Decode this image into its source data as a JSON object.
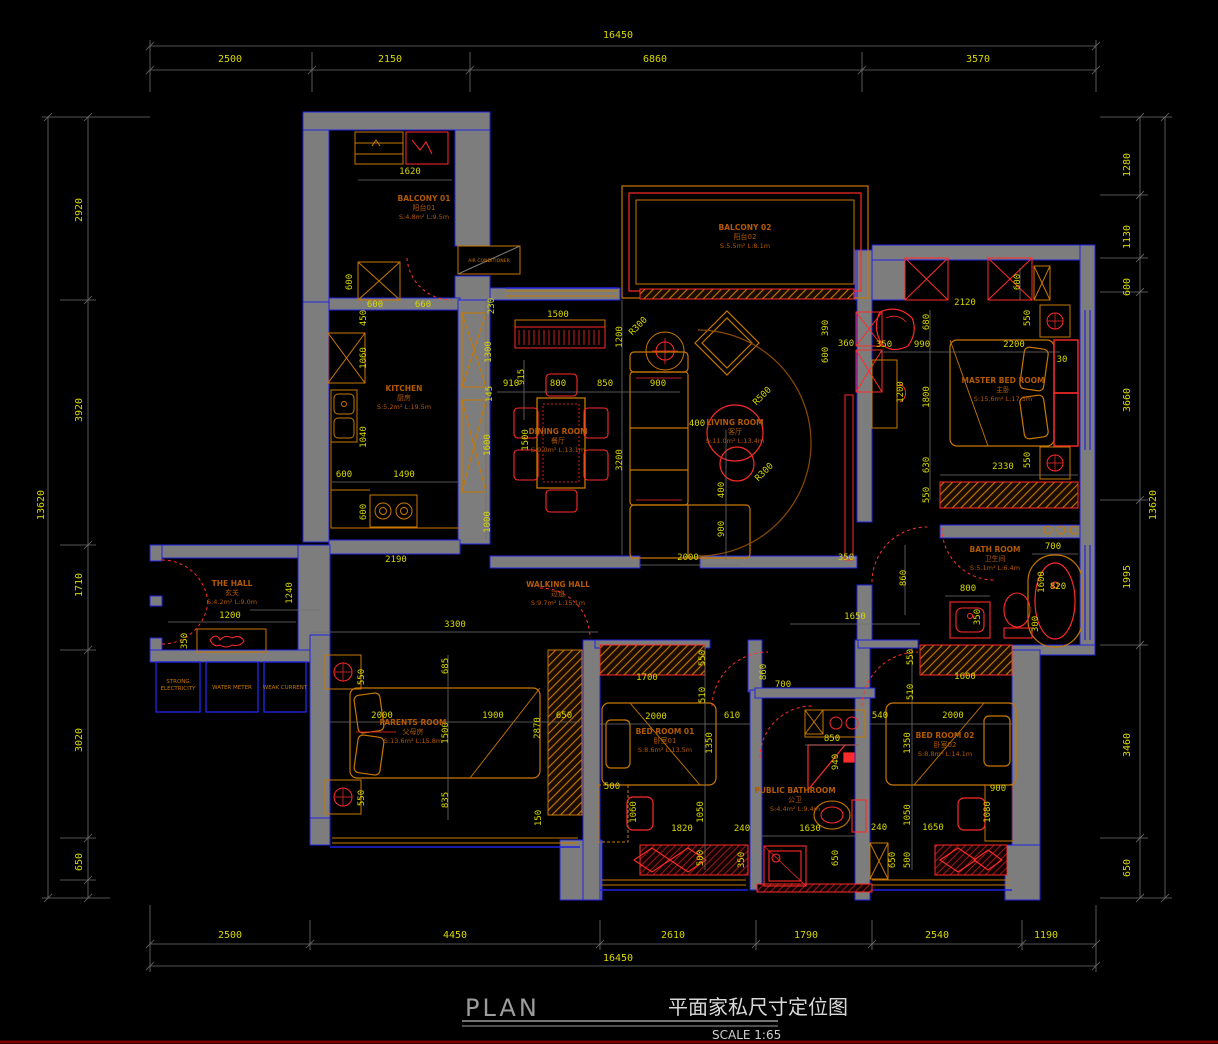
{
  "title_block": {
    "plan": "PLAN",
    "cn_title": "平面家私尺寸定位图",
    "scale": "SCALE 1:65"
  },
  "colors": {
    "background": "#000000",
    "wall_fill": "#7d7d7d",
    "outline_blue": "#2222e0",
    "dimension_text": "#d8d800",
    "dimension_line": "#6f6f6f",
    "furniture_orange": "#c87800",
    "furniture_red": "#ff2a2a",
    "room_label": "#b35900",
    "title_gray": "#9c9c9c",
    "bottom_rule_dark_red": "#7a0000"
  },
  "outer_dimensions": {
    "top": {
      "total": "16450",
      "segments": [
        "2500",
        "2150",
        "6860",
        "3570"
      ]
    },
    "bottom": {
      "total": "16450",
      "segments": [
        "2500",
        "4450",
        "2610",
        "1790",
        "2540",
        "1190"
      ]
    },
    "left": {
      "total": "13620",
      "segments": [
        "2920",
        "3920",
        "1710",
        "3020",
        "650"
      ]
    },
    "right": {
      "total": "13620",
      "segments": [
        "1280",
        "1130",
        "600",
        "3660",
        "1995",
        "3460",
        "650"
      ]
    }
  },
  "rooms": [
    {
      "id": "balcony-01",
      "name": "BALCONY 01",
      "cn": "阳台01",
      "info": "S:4.8m²  L:9.5m",
      "x": 424,
      "y": 201
    },
    {
      "id": "balcony-02",
      "name": "BALCONY 02",
      "cn": "阳台02",
      "info": "S:5.5m²  L:8.1m",
      "x": 745,
      "y": 230
    },
    {
      "id": "kitchen",
      "name": "KITCHEN",
      "cn": "厨房",
      "info": "S:5.2m²  L:19.5m",
      "x": 404,
      "y": 391
    },
    {
      "id": "dining-room",
      "name": "DINING ROOM",
      "cn": "餐厅",
      "info": "S:9.0m²  L:13.1m",
      "x": 558,
      "y": 434
    },
    {
      "id": "living-room",
      "name": "LIVING ROOM",
      "cn": "客厅",
      "info": "S:11.0m²  L:13.4m",
      "x": 735,
      "y": 425
    },
    {
      "id": "master-bed-room",
      "name": "MASTER BED ROOM",
      "cn": "主卧",
      "info": "S:15.6m²  L:17.3m",
      "x": 1003,
      "y": 383
    },
    {
      "id": "bath-room",
      "name": "BATH ROOM",
      "cn": "卫生间",
      "info": "S:5.1m²  L:6.4m",
      "x": 995,
      "y": 552
    },
    {
      "id": "the-hall",
      "name": "THE HALL",
      "cn": "玄关",
      "info": "S:4.2m²  L:9.0m",
      "x": 232,
      "y": 586
    },
    {
      "id": "walking-hall",
      "name": "WALKING HALL",
      "cn": "过道",
      "info": "S:9.7m²  L:15.1m",
      "x": 558,
      "y": 587
    },
    {
      "id": "parents-room",
      "name": "PARENTS ROOM",
      "cn": "父母房",
      "info": "S:13.6m²  L:15.8m",
      "x": 413,
      "y": 725
    },
    {
      "id": "bed-room-01",
      "name": "BED ROOM 01",
      "cn": "卧室01",
      "info": "S:8.6m²  L:13.5m",
      "x": 665,
      "y": 734
    },
    {
      "id": "public-bathroom",
      "name": "PUBLIC BATHROOM",
      "cn": "公卫",
      "info": "S:4.4m²  L:9.4m",
      "x": 795,
      "y": 793
    },
    {
      "id": "bed-room-02",
      "name": "BED ROOM 02",
      "cn": "卧室02",
      "info": "S:8.8m²  L:14.1m",
      "x": 945,
      "y": 738
    }
  ],
  "utilities": [
    {
      "lines": [
        "STRONG",
        "ELECTRICITY"
      ],
      "x": 178,
      "y": 683
    },
    {
      "lines": [
        "WATER METER"
      ],
      "x": 232,
      "y": 689
    },
    {
      "lines": [
        "WEAK CURRENT"
      ],
      "x": 285,
      "y": 689
    }
  ],
  "equipment": {
    "air_conditioner": "AIR CONDITIONER",
    "x": 489,
    "y": 262
  },
  "dim_labels": [
    {
      "g": "top",
      "t": "16450",
      "x": 618,
      "y": 38,
      "r": 0,
      "big": true
    },
    {
      "g": "top",
      "t": "2500",
      "x": 230,
      "y": 62,
      "r": 0,
      "big": true
    },
    {
      "g": "top",
      "t": "2150",
      "x": 390,
      "y": 62,
      "r": 0,
      "big": true
    },
    {
      "g": "top",
      "t": "6860",
      "x": 655,
      "y": 62,
      "r": 0,
      "big": true
    },
    {
      "g": "top",
      "t": "3570",
      "x": 978,
      "y": 62,
      "r": 0,
      "big": true
    },
    {
      "g": "bottom",
      "t": "2500",
      "x": 230,
      "y": 938,
      "r": 0,
      "big": true
    },
    {
      "g": "bottom",
      "t": "4450",
      "x": 455,
      "y": 938,
      "r": 0,
      "big": true
    },
    {
      "g": "bottom",
      "t": "2610",
      "x": 673,
      "y": 938,
      "r": 0,
      "big": true
    },
    {
      "g": "bottom",
      "t": "1790",
      "x": 806,
      "y": 938,
      "r": 0,
      "big": true
    },
    {
      "g": "bottom",
      "t": "2540",
      "x": 937,
      "y": 938,
      "r": 0,
      "big": true
    },
    {
      "g": "bottom",
      "t": "1190",
      "x": 1046,
      "y": 938,
      "r": 0,
      "big": true
    },
    {
      "g": "bottom",
      "t": "16450",
      "x": 618,
      "y": 961,
      "r": 0,
      "big": true
    },
    {
      "g": "left",
      "t": "13620",
      "x": 44,
      "y": 505,
      "r": -90,
      "big": true
    },
    {
      "g": "left",
      "t": "2920",
      "x": 82,
      "y": 210,
      "r": -90,
      "big": true
    },
    {
      "g": "left",
      "t": "3920",
      "x": 82,
      "y": 410,
      "r": -90,
      "big": true
    },
    {
      "g": "left",
      "t": "1710",
      "x": 82,
      "y": 585,
      "r": -90,
      "big": true
    },
    {
      "g": "left",
      "t": "3020",
      "x": 82,
      "y": 740,
      "r": -90,
      "big": true
    },
    {
      "g": "left",
      "t": "650",
      "x": 82,
      "y": 862,
      "r": -90,
      "big": true
    },
    {
      "g": "right",
      "t": "13620",
      "x": 1156,
      "y": 505,
      "r": -90,
      "big": true
    },
    {
      "g": "right",
      "t": "1280",
      "x": 1130,
      "y": 165,
      "r": -90,
      "big": true
    },
    {
      "g": "right",
      "t": "1130",
      "x": 1130,
      "y": 237,
      "r": -90,
      "big": true
    },
    {
      "g": "right",
      "t": "600",
      "x": 1130,
      "y": 287,
      "r": -90,
      "big": true
    },
    {
      "g": "right",
      "t": "3660",
      "x": 1130,
      "y": 400,
      "r": -90,
      "big": true
    },
    {
      "g": "right",
      "t": "1995",
      "x": 1130,
      "y": 577,
      "r": -90,
      "big": true
    },
    {
      "g": "right",
      "t": "3460",
      "x": 1130,
      "y": 745,
      "r": -90,
      "big": true
    },
    {
      "g": "right",
      "t": "650",
      "x": 1130,
      "y": 868,
      "r": -90,
      "big": true
    },
    {
      "g": "balcony01",
      "t": "1620",
      "x": 410,
      "y": 174,
      "r": 0
    },
    {
      "g": "balcony01",
      "t": "600",
      "x": 352,
      "y": 282,
      "r": -90
    },
    {
      "g": "balcony01",
      "t": "600",
      "x": 375,
      "y": 307,
      "r": 0
    },
    {
      "g": "balcony01",
      "t": "660",
      "x": 423,
      "y": 307,
      "r": 0
    },
    {
      "g": "balcony01",
      "t": "450",
      "x": 366,
      "y": 318,
      "r": -90
    },
    {
      "g": "kitchen",
      "t": "230",
      "x": 494,
      "y": 306,
      "r": -90
    },
    {
      "g": "kitchen",
      "t": "1300",
      "x": 491,
      "y": 352,
      "r": -90
    },
    {
      "g": "kitchen",
      "t": "145",
      "x": 492,
      "y": 394,
      "r": -90
    },
    {
      "g": "kitchen",
      "t": "1600",
      "x": 490,
      "y": 445,
      "r": -90
    },
    {
      "g": "kitchen",
      "t": "1000",
      "x": 490,
      "y": 522,
      "r": -90
    },
    {
      "g": "kitchen",
      "t": "1060",
      "x": 366,
      "y": 358,
      "r": -90
    },
    {
      "g": "kitchen",
      "t": "1040",
      "x": 366,
      "y": 437,
      "r": -90
    },
    {
      "g": "kitchen",
      "t": "600",
      "x": 344,
      "y": 477,
      "r": 0
    },
    {
      "g": "kitchen",
      "t": "1490",
      "x": 404,
      "y": 477,
      "r": 0
    },
    {
      "g": "kitchen",
      "t": "600",
      "x": 366,
      "y": 512,
      "r": -90
    },
    {
      "g": "corridor",
      "t": "2190",
      "x": 396,
      "y": 562,
      "r": 0
    },
    {
      "g": "dining",
      "t": "1500",
      "x": 558,
      "y": 317,
      "r": 0
    },
    {
      "g": "dining",
      "t": "1200",
      "x": 622,
      "y": 337,
      "r": -90
    },
    {
      "g": "dining",
      "t": "915",
      "x": 524,
      "y": 377,
      "r": -90
    },
    {
      "g": "dining",
      "t": "910",
      "x": 511,
      "y": 386,
      "r": 0
    },
    {
      "g": "dining",
      "t": "800",
      "x": 558,
      "y": 386,
      "r": 0
    },
    {
      "g": "dining",
      "t": "850",
      "x": 605,
      "y": 386,
      "r": 0
    },
    {
      "g": "dining",
      "t": "900",
      "x": 658,
      "y": 386,
      "r": 0
    },
    {
      "g": "dining",
      "t": "1500",
      "x": 528,
      "y": 440,
      "r": -90
    },
    {
      "g": "dining",
      "t": "3200",
      "x": 622,
      "y": 460,
      "r": -90
    },
    {
      "g": "dining",
      "t": "R300",
      "x": 640,
      "y": 328,
      "r": -45
    },
    {
      "g": "living",
      "t": "400",
      "x": 697,
      "y": 426,
      "r": 0
    },
    {
      "g": "living",
      "t": "R500",
      "x": 764,
      "y": 398,
      "r": -45
    },
    {
      "g": "living",
      "t": "R300",
      "x": 766,
      "y": 474,
      "r": -45
    },
    {
      "g": "living",
      "t": "400",
      "x": 724,
      "y": 490,
      "r": -90
    },
    {
      "g": "living",
      "t": "900",
      "x": 724,
      "y": 529,
      "r": -90
    },
    {
      "g": "living",
      "t": "2000",
      "x": 688,
      "y": 560,
      "r": 0
    },
    {
      "g": "living",
      "t": "390",
      "x": 828,
      "y": 328,
      "r": -90
    },
    {
      "g": "living",
      "t": "600",
      "x": 828,
      "y": 355,
      "r": -90
    },
    {
      "g": "living",
      "t": "360",
      "x": 846,
      "y": 346,
      "r": 0
    },
    {
      "g": "living",
      "t": "350",
      "x": 846,
      "y": 560,
      "r": 0
    },
    {
      "g": "master",
      "t": "2120",
      "x": 965,
      "y": 305,
      "r": 0
    },
    {
      "g": "master",
      "t": "680",
      "x": 929,
      "y": 322,
      "r": -90
    },
    {
      "g": "master",
      "t": "550",
      "x": 1030,
      "y": 318,
      "r": -90
    },
    {
      "g": "master",
      "t": "350",
      "x": 884,
      "y": 347,
      "r": 0
    },
    {
      "g": "master",
      "t": "990",
      "x": 922,
      "y": 347,
      "r": 0
    },
    {
      "g": "master",
      "t": "2200",
      "x": 1014,
      "y": 347,
      "r": 0
    },
    {
      "g": "master",
      "t": "30",
      "x": 1062,
      "y": 362,
      "r": 0
    },
    {
      "g": "master",
      "t": "600",
      "x": 1020,
      "y": 282,
      "r": -90
    },
    {
      "g": "master",
      "t": "1200",
      "x": 903,
      "y": 392,
      "r": -90
    },
    {
      "g": "master",
      "t": "1800",
      "x": 929,
      "y": 397,
      "r": -90
    },
    {
      "g": "master",
      "t": "630",
      "x": 929,
      "y": 465,
      "r": -90
    },
    {
      "g": "master",
      "t": "550",
      "x": 1030,
      "y": 460,
      "r": -90
    },
    {
      "g": "master",
      "t": "2330",
      "x": 1003,
      "y": 469,
      "r": 0
    },
    {
      "g": "master",
      "t": "550",
      "x": 929,
      "y": 495,
      "r": -90
    },
    {
      "g": "corridor",
      "t": "860",
      "x": 906,
      "y": 578,
      "r": -90
    },
    {
      "g": "bath",
      "t": "700",
      "x": 1053,
      "y": 549,
      "r": 0
    },
    {
      "g": "bath",
      "t": "1600",
      "x": 1044,
      "y": 582,
      "r": -90
    },
    {
      "g": "bath",
      "t": "820",
      "x": 1058,
      "y": 589,
      "r": 0
    },
    {
      "g": "bath",
      "t": "800",
      "x": 968,
      "y": 591,
      "r": 0
    },
    {
      "g": "bath",
      "t": "350",
      "x": 980,
      "y": 617,
      "r": -90
    },
    {
      "g": "bath",
      "t": "300",
      "x": 1038,
      "y": 624,
      "r": -90
    },
    {
      "g": "hall",
      "t": "1240",
      "x": 292,
      "y": 593,
      "r": -90
    },
    {
      "g": "hall",
      "t": "1200",
      "x": 230,
      "y": 618,
      "r": 0
    },
    {
      "g": "hall",
      "t": "350",
      "x": 187,
      "y": 641,
      "r": -90
    },
    {
      "g": "corridor",
      "t": "3300",
      "x": 455,
      "y": 627,
      "r": 0
    },
    {
      "g": "corridor",
      "t": "1650",
      "x": 855,
      "y": 619,
      "r": 0
    },
    {
      "g": "corridor",
      "t": "700",
      "x": 783,
      "y": 687,
      "r": 0
    },
    {
      "g": "parents",
      "t": "550",
      "x": 364,
      "y": 677,
      "r": -90
    },
    {
      "g": "parents",
      "t": "685",
      "x": 448,
      "y": 666,
      "r": -90
    },
    {
      "g": "parents",
      "t": "2000",
      "x": 382,
      "y": 718,
      "r": 0
    },
    {
      "g": "parents",
      "t": "1900",
      "x": 493,
      "y": 718,
      "r": 0
    },
    {
      "g": "parents",
      "t": "1500",
      "x": 448,
      "y": 733,
      "r": -90
    },
    {
      "g": "parents",
      "t": "2870",
      "x": 540,
      "y": 728,
      "r": -90
    },
    {
      "g": "parents",
      "t": "650",
      "x": 564,
      "y": 718,
      "r": 0
    },
    {
      "g": "parents",
      "t": "835",
      "x": 448,
      "y": 800,
      "r": -90
    },
    {
      "g": "parents",
      "t": "550",
      "x": 364,
      "y": 798,
      "r": -90
    },
    {
      "g": "parents",
      "t": "150",
      "x": 541,
      "y": 818,
      "r": -90
    },
    {
      "g": "bed01",
      "t": "550",
      "x": 705,
      "y": 658,
      "r": -90
    },
    {
      "g": "bed01",
      "t": "1700",
      "x": 647,
      "y": 680,
      "r": 0
    },
    {
      "g": "bed01",
      "t": "510",
      "x": 705,
      "y": 695,
      "r": -90
    },
    {
      "g": "bed01",
      "t": "2000",
      "x": 656,
      "y": 719,
      "r": 0
    },
    {
      "g": "bed01",
      "t": "610",
      "x": 732,
      "y": 718,
      "r": 0
    },
    {
      "g": "bed01",
      "t": "1350",
      "x": 712,
      "y": 743,
      "r": -90
    },
    {
      "g": "bed01",
      "t": "860",
      "x": 766,
      "y": 672,
      "r": -90
    },
    {
      "g": "bed01",
      "t": "500",
      "x": 612,
      "y": 789,
      "r": 0
    },
    {
      "g": "bed01",
      "t": "1060",
      "x": 636,
      "y": 812,
      "r": -90
    },
    {
      "g": "bed01",
      "t": "1050",
      "x": 703,
      "y": 812,
      "r": -90
    },
    {
      "g": "bed01",
      "t": "1820",
      "x": 682,
      "y": 831,
      "r": 0
    },
    {
      "g": "bed01",
      "t": "240",
      "x": 742,
      "y": 831,
      "r": 0
    },
    {
      "g": "bed01",
      "t": "500",
      "x": 703,
      "y": 858,
      "r": -90
    },
    {
      "g": "bed01",
      "t": "350",
      "x": 744,
      "y": 860,
      "r": -90
    },
    {
      "g": "pubbath",
      "t": "850",
      "x": 832,
      "y": 741,
      "r": 0
    },
    {
      "g": "pubbath",
      "t": "940",
      "x": 838,
      "y": 762,
      "r": -90
    },
    {
      "g": "pubbath",
      "t": "1630",
      "x": 810,
      "y": 831,
      "r": 0
    },
    {
      "g": "pubbath",
      "t": "650",
      "x": 838,
      "y": 858,
      "r": -90
    },
    {
      "g": "bed02",
      "t": "550",
      "x": 913,
      "y": 657,
      "r": -90
    },
    {
      "g": "bed02",
      "t": "1600",
      "x": 965,
      "y": 679,
      "r": 0
    },
    {
      "g": "bed02",
      "t": "510",
      "x": 913,
      "y": 692,
      "r": -90
    },
    {
      "g": "bed02",
      "t": "540",
      "x": 880,
      "y": 718,
      "r": 0
    },
    {
      "g": "bed02",
      "t": "2000",
      "x": 953,
      "y": 718,
      "r": 0
    },
    {
      "g": "bed02",
      "t": "1350",
      "x": 910,
      "y": 743,
      "r": -90
    },
    {
      "g": "bed02",
      "t": "1050",
      "x": 910,
      "y": 815,
      "r": -90
    },
    {
      "g": "bed02",
      "t": "900",
      "x": 998,
      "y": 791,
      "r": 0
    },
    {
      "g": "bed02",
      "t": "1080",
      "x": 990,
      "y": 812,
      "r": -90
    },
    {
      "g": "bed02",
      "t": "240",
      "x": 879,
      "y": 830,
      "r": 0
    },
    {
      "g": "bed02",
      "t": "1650",
      "x": 933,
      "y": 830,
      "r": 0
    },
    {
      "g": "bed02",
      "t": "500",
      "x": 910,
      "y": 860,
      "r": -90
    },
    {
      "g": "bed02",
      "t": "650",
      "x": 895,
      "y": 860,
      "r": -90
    }
  ]
}
